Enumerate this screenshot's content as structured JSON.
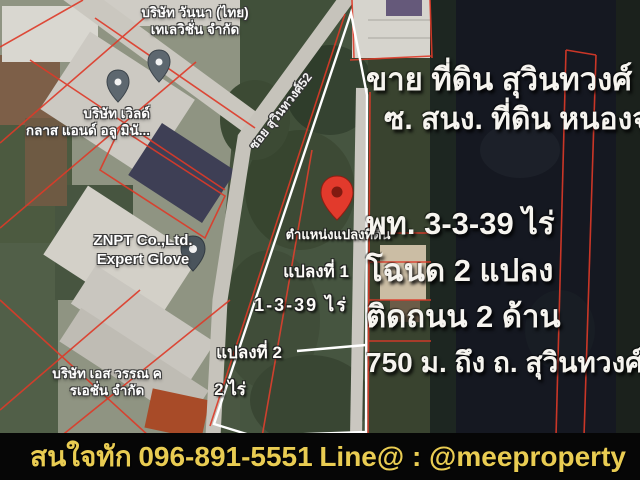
{
  "listing": {
    "title_line1": "ขาย ที่ดิน สุวินทวงศ์ 52",
    "title_line2": "ซ. สนง. ที่ดิน หนองจอก",
    "details": [
      "พท. 3-3-39 ไร่",
      "โฉนด 2 แปลง",
      "ติดถนน 2 ด้าน",
      "750 ม. ถึง ถ. สุวินทวงศ์"
    ]
  },
  "map": {
    "street_label": "ซอย สุวินทวงศ์52",
    "poi": [
      {
        "name": "บริษัท วันนา (ไทย)\nเทเลวิชั่น จำกัด"
      },
      {
        "name": "บริษัท เวิลด์\nกลาส แอนด์ อลู มินั..."
      },
      {
        "name": "ZNPT Co.,Ltd.\nExpert Glove"
      },
      {
        "name": "บริษัท เอส วรรณ ค\nรเอชั่น จำกัด"
      }
    ],
    "pin_caption": "ตำแหน่งแปลงที่ดิน",
    "plot1_name": "แปลงที่ 1",
    "plot1_area": "1-3-39 ไร่",
    "plot2_name": "แปลงที่ 2",
    "plot2_area": "2 ไร่"
  },
  "footer": {
    "contact_prefix": "สนใจทัก",
    "phone": "096-891-5551",
    "line_label": "Line@ : @meeproperty"
  },
  "colors": {
    "banner_bg": "#060606",
    "banner_text": "#e9cc52",
    "headline_text": "#f6f4ef",
    "cadastral_red": "#de3a28",
    "plot_outline_white": "#ffffff",
    "main_pin_red": "#e23a2c",
    "poi_pin_gray": "#5d676f",
    "dark_land": "#151821"
  }
}
